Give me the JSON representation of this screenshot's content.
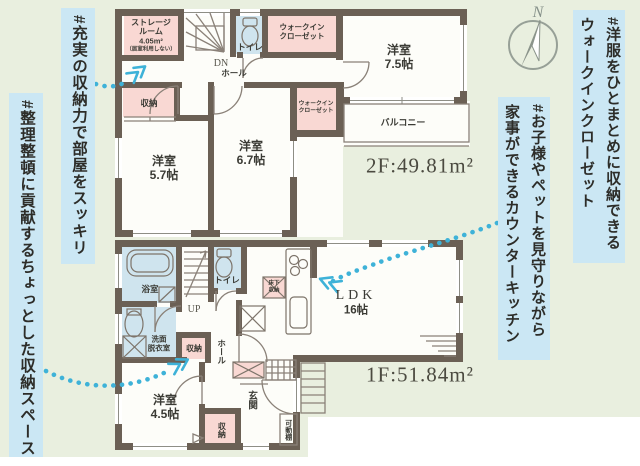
{
  "colors": {
    "background": "#e9efdf",
    "band": "#cbe7f4",
    "wall": "#6b6055",
    "room_pink": "#f9d8d3",
    "room_blue": "#cfe4ee",
    "floor": "#fdfdf9",
    "arrow": "#3eb2d8",
    "text": "#3b3b35",
    "area_text": "#4b4a40",
    "compass": "#97a097"
  },
  "compass": {
    "north_label": "N"
  },
  "annotations": {
    "left_outer": "#整理整頓に貢献するちょっとした収納スペース",
    "left_inner": "#充実の収納力で部屋をスッキリ",
    "right_top_line1": "#洋服をひとまとめに収納できる",
    "right_top_line2": "ウォークインクローゼット",
    "right_mid_line1": "#お子様やペットを見守りながら",
    "right_mid_line2": "家事ができるカウンターキッチン"
  },
  "floor2": {
    "area_label": "2F:49.81m²",
    "storage_room_line1": "ストレージ",
    "storage_room_line2": "ルーム",
    "storage_room_line3": "4.05m²",
    "storage_room_line4": "（居室利用しない）",
    "toilet": "トイレ",
    "wic_top_line1": "ウォークイン",
    "wic_top_line2": "クローゼット",
    "wic_right_line1": "ウォークイン",
    "wic_right_line2": "クローゼット",
    "stairs": "DN",
    "hall": "ホール",
    "closet": "収納",
    "room57_name": "洋室",
    "room57_size": "5.7帖",
    "room67_name": "洋室",
    "room67_size": "6.7帖",
    "room75_name": "洋室",
    "room75_size": "7.5帖",
    "balcony": "バルコニー"
  },
  "floor1": {
    "area_label": "1F:51.84m²",
    "bath": "浴室",
    "washroom_line1": "洗面",
    "washroom_line2": "脱衣室",
    "stairs": "UP",
    "toilet": "トイレ",
    "hall": "ホール",
    "closet_mid": "収納",
    "ldk_name": "LDK",
    "ldk_size": "16帖",
    "underfloor_line1": "床下",
    "underfloor_line2": "収納",
    "room45_name": "洋室",
    "room45_size": "4.5帖",
    "closet_bottom": "収納",
    "entrance": "玄関",
    "shelf": "可動棚"
  }
}
